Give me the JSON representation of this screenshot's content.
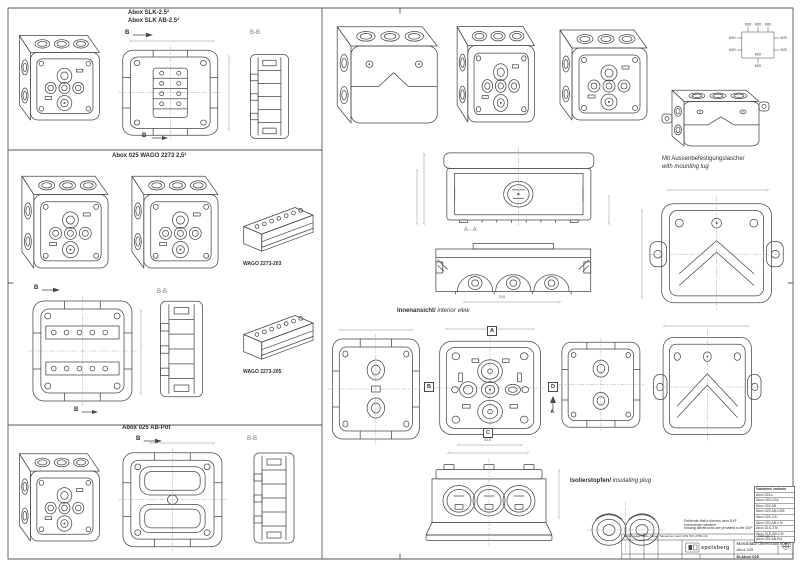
{
  "colors": {
    "line": "#474747",
    "dim": "#909090",
    "paper": "#ffffff",
    "frame": "#5a5a5a"
  },
  "slk": {
    "title1": "Abox SLK-2.5²",
    "title2": "Abox SLK AB-2.5²",
    "marker_b": "B",
    "section_bb": "B-B"
  },
  "wago": {
    "title": "Abox 025 WAGO 2273 2,5²",
    "conn1": "WAGO 2273-203",
    "conn2": "WAGO 2273-205",
    "marker_b": "B",
    "section_bb": "B-B"
  },
  "abpot": {
    "title": "Abox 025 AB-Pot",
    "marker_b": "B",
    "section_bb": "B-B"
  },
  "main": {
    "knockout": "M20",
    "mount_de": "Mit Aussenbefestigungslasche/",
    "mount_en": "with mounting lug",
    "interior_de": "Innenansicht/",
    "interior_en": " interior view",
    "aa": "A - A",
    "dim_aa": "75,8",
    "dim_int": "53,8",
    "ins_de": "Isolierstopfen/",
    "ins_en": " insulating plug",
    "mk_a": "A",
    "mk_b": "B",
    "mk_c": "C",
    "mk_d": "D"
  },
  "tb": {
    "variants_header": "Varianten/ variants",
    "variants": [
      "Abox 025-L",
      "Abox 025-L/SA",
      "Abox 025-AB",
      "Abox 025-AB-L/SB",
      "Abox 025-2,5²",
      "Abox 025-AB-2,5²",
      "Abox SLK-2,5²",
      "Abox SLK-AB-2,5²",
      "Abox 025-AB-Pot"
    ],
    "note_de": "Fehlende Maße können dem DXF entnommen werden/",
    "note_en": "missing dimensions are provided in the DXF",
    "tol": "Unbemaßte Maße haben Toleranzen nach DIN ISO 2768-mK",
    "scale": "Maßstab 1:1",
    "company": "spelsberg",
    "doc": "Massblatt/ dimension sheet",
    "product": "Abox 025",
    "number": "M-Abox 025"
  }
}
